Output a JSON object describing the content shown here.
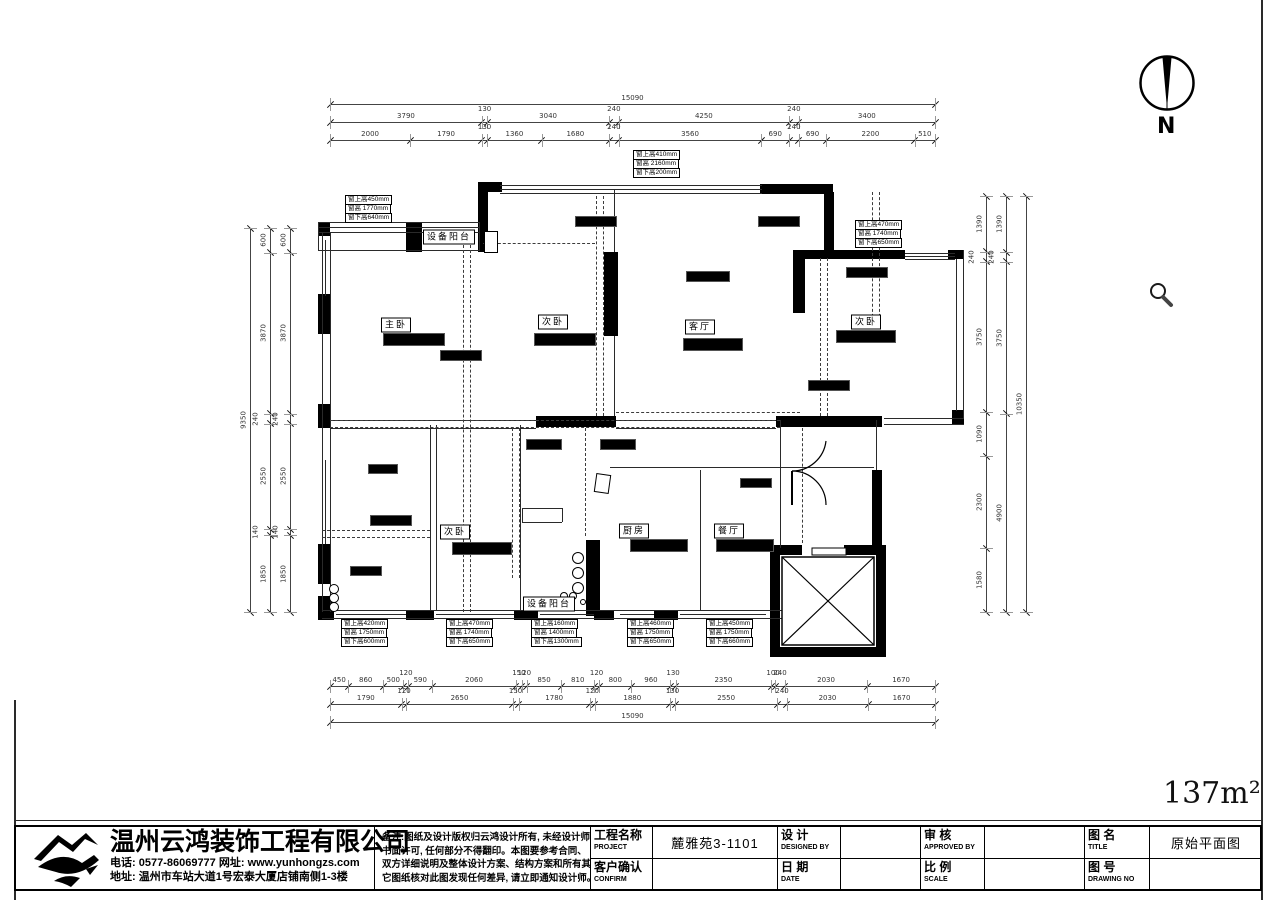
{
  "meta": {
    "area_label": "137m²",
    "north_label": "N"
  },
  "plan": {
    "rooms": [
      {
        "text": "主卧"
      },
      {
        "text": "次卧"
      },
      {
        "text": "客厅"
      },
      {
        "text": "次卧"
      },
      {
        "text": "次卧"
      },
      {
        "text": "厨房"
      },
      {
        "text": "餐厅"
      },
      {
        "text": "设备阳台"
      },
      {
        "text": "设备阳台"
      }
    ],
    "window_annotations": [
      {
        "lines": [
          "窗上高450mm",
          "窗高 1770mm",
          "窗下高640mm"
        ]
      },
      {
        "lines": [
          "窗上高410mm",
          "窗高 2160mm",
          "窗下高200mm"
        ]
      },
      {
        "lines": [
          "窗上高470mm",
          "窗高 1740mm",
          "窗下高650mm"
        ]
      },
      {
        "lines": [
          "窗上高420mm",
          "窗高 1750mm",
          "窗下高600mm"
        ]
      },
      {
        "lines": [
          "窗上高470mm",
          "窗高 1740mm",
          "窗下高650mm"
        ]
      },
      {
        "lines": [
          "窗上高160mm",
          "窗高 1400mm",
          "窗下高1300mm"
        ]
      },
      {
        "lines": [
          "窗上高460mm",
          "窗高 1750mm",
          "窗下高650mm"
        ]
      },
      {
        "lines": [
          "窗上高450mm",
          "窗高 1750mm",
          "窗下高660mm"
        ]
      }
    ],
    "dimensions": {
      "top_total": [
        "15090"
      ],
      "top_row2": [
        "3790",
        "130",
        "3040",
        "240",
        "4250",
        "240",
        "3400"
      ],
      "top_row3": [
        "2000",
        "1790",
        "130",
        "1360",
        "1680",
        "240",
        "3560",
        "690",
        "240",
        "690",
        "2200",
        "510"
      ],
      "bottom_row1": [
        "450",
        "860",
        "500",
        "120",
        "590",
        "2060",
        "150",
        "120",
        "850",
        "810",
        "120",
        "800",
        "960",
        "130",
        "2350",
        "100",
        "240",
        "2030",
        "1670"
      ],
      "bottom_row2": [
        "1790",
        "120",
        "2650",
        "150",
        "1780",
        "120",
        "1880",
        "130",
        "2550",
        "240",
        "2030",
        "1670"
      ],
      "bottom_total": [
        "15090"
      ],
      "left_total": [
        "9350"
      ],
      "left_inner": [
        "600",
        "3870",
        "240",
        "2550",
        "140",
        "1850"
      ],
      "left_inner2": [
        "600",
        "3870",
        "240",
        "2550",
        "140",
        "1850"
      ],
      "right_inner": [
        "1390",
        "240",
        "3750",
        "1090",
        "2300",
        "1580"
      ],
      "right_mid": [
        "1390",
        "240",
        "3750",
        "4900"
      ],
      "right_total": [
        "10350"
      ]
    }
  },
  "titleblock": {
    "company": {
      "name": "温州云鸿装饰工程有限公司",
      "phone_line": "电话: 0577-86069777 网址: www.yunhongzs.com",
      "addr_line": "地址: 温州市车站大道1号宏泰大厦店铺南侧1-3楼"
    },
    "notes_lines": [
      "备注:图纸及设计版权归云鸿设计所有, 未经设计师",
      "书面许可, 任何部分不得翻印。本图要参考合同、",
      "双方详细说明及整体设计方案、结构方案和所有其",
      "它图纸核对此图发现任何差异, 请立即通知设计师。"
    ],
    "fields": [
      {
        "label": "工程名称",
        "sub": "PROJECT",
        "value": "麓雅苑3-1101"
      },
      {
        "label": "设  计",
        "sub": "DESIGNED BY",
        "value": ""
      },
      {
        "label": "审  核",
        "sub": "APPROVED BY",
        "value": ""
      },
      {
        "label": "图  名",
        "sub": "TITLE",
        "value": "原始平面图"
      },
      {
        "label": "客户确认",
        "sub": "CONFIRM",
        "value": ""
      },
      {
        "label": "日  期",
        "sub": "DATE",
        "value": ""
      },
      {
        "label": "比  例",
        "sub": "SCALE",
        "value": ""
      },
      {
        "label": "图  号",
        "sub": "DRAWING NO",
        "value": ""
      }
    ]
  }
}
